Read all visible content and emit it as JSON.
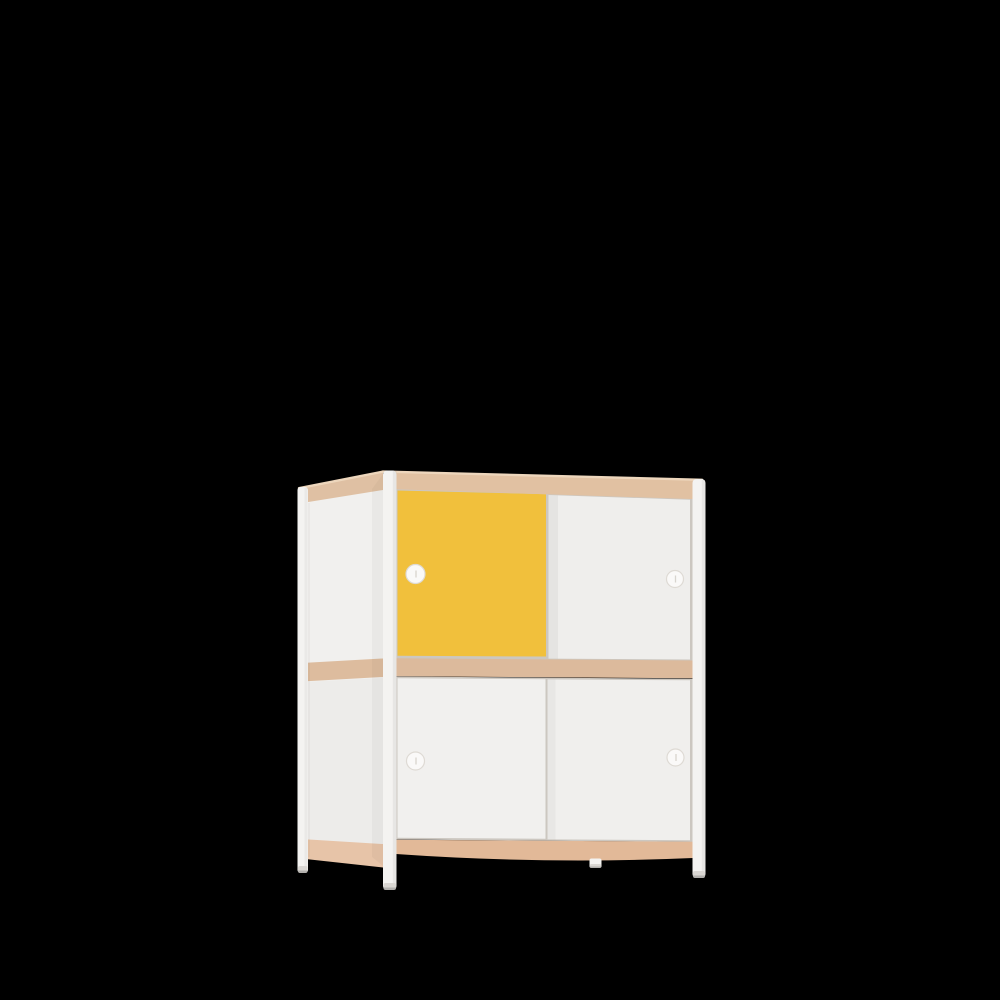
{
  "scene": {
    "object": "two-tier sliding-door cabinet",
    "description": "3D product render of a small two-tier cabinet with four sliding doors (one yellow, three white), plywood edge bands and round white steel legs, shown in three-quarter view on a plain black background",
    "view": "front three-quarter from the left",
    "background_color": "#000000"
  },
  "cabinet": {
    "tiers": 2,
    "doors": [
      {
        "position": "top-left",
        "color_name": "yellow",
        "handle": "round finger hole"
      },
      {
        "position": "top-right",
        "color_name": "white",
        "handle": "round finger hole"
      },
      {
        "position": "bottom-left",
        "color_name": "white",
        "handle": "round finger hole"
      },
      {
        "position": "bottom-right",
        "color_name": "white",
        "handle": "round finger hole"
      }
    ],
    "frame": "four round white legs",
    "edges": "natural plywood edge banding at top, middle shelf and bottom"
  },
  "colors": {
    "background": "#000000",
    "side_panel": "#F1F0EE",
    "band_side_top": "#DFC0A3",
    "band_side_mid": "#DDBC9E",
    "band_side_bottom": "#E7C4A8",
    "band_front_top": "#E1C1A2",
    "band_front_mid": "#DCBA9C",
    "band_front_bottom": "#E2B998",
    "door_yellow": "#F1C03C",
    "door_top_right": "#EFEEEC",
    "door_bottom_left": "#F1F0EE",
    "door_bottom_right": "#F0EFED",
    "underlay": "#CCC7C0",
    "leg": "#F4F3F1",
    "leg_foot": "#DAD7D3",
    "edge_highlight": "#EDD6BC",
    "handle_fill": "#FAF9F8",
    "handle_stroke": "#DEDAD4",
    "handle_slit": "#D8D4CE"
  }
}
